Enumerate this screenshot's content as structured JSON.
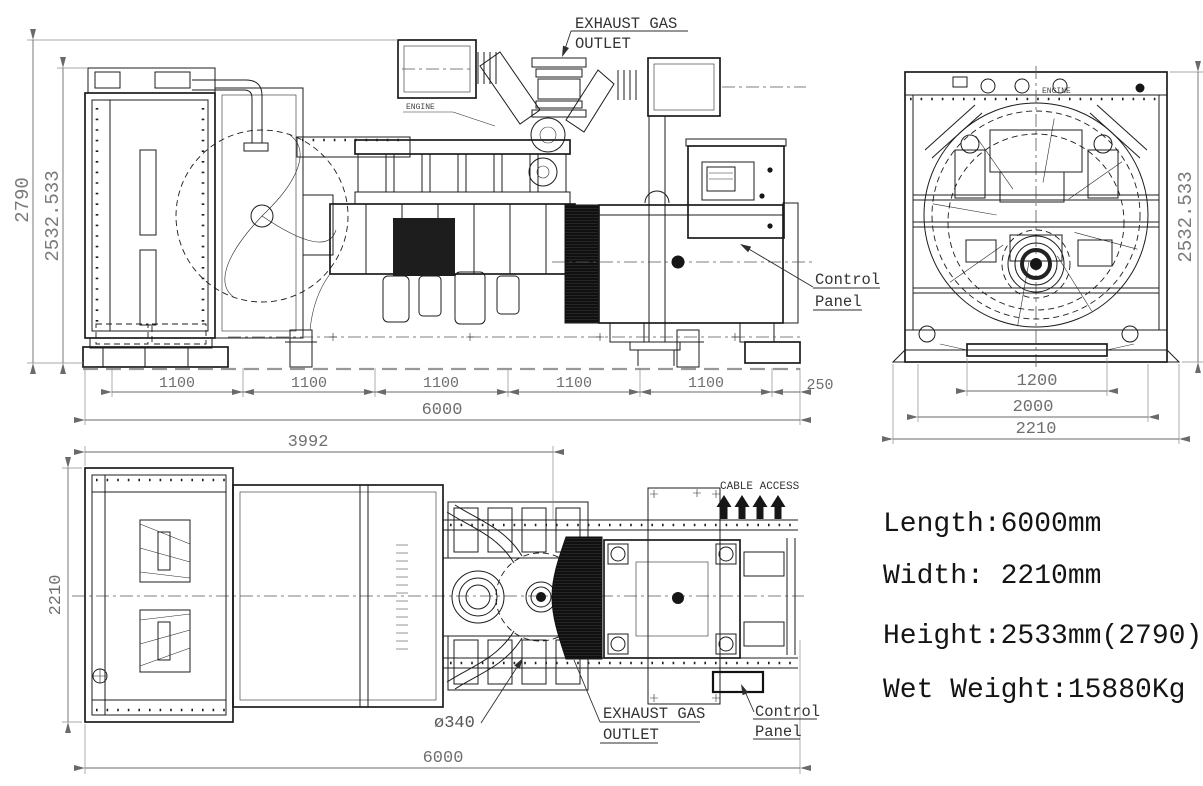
{
  "labels": {
    "exhaust_gas_line1": "EXHAUST GAS",
    "exhaust_gas_line2": "OUTLET",
    "control_line1": "Control",
    "control_line2": "Panel",
    "cable_access": "CABLE ACCESS",
    "engine_tag": "ENGINE",
    "exhaust_diameter": "ø340"
  },
  "side_view": {
    "dim_height_overall": "2790",
    "dim_height_body": "2532.533",
    "chain": [
      "1100",
      "1100",
      "1100",
      "1100",
      "1100",
      "250"
    ],
    "dim_length_overall": "6000"
  },
  "end_view": {
    "dim_height_body": "2532.533",
    "dim_width_base": "1200",
    "dim_width_mid": "2000",
    "dim_width_overall": "2210"
  },
  "plan_view": {
    "dim_length_front": "3992",
    "dim_width_overall": "2210",
    "dim_length_overall": "6000"
  },
  "specs": {
    "length": "Length:6000mm",
    "width": "Width: 2210mm",
    "height": "Height:2533mm(2790)",
    "wet_weight": "Wet Weight:15880Kg"
  }
}
